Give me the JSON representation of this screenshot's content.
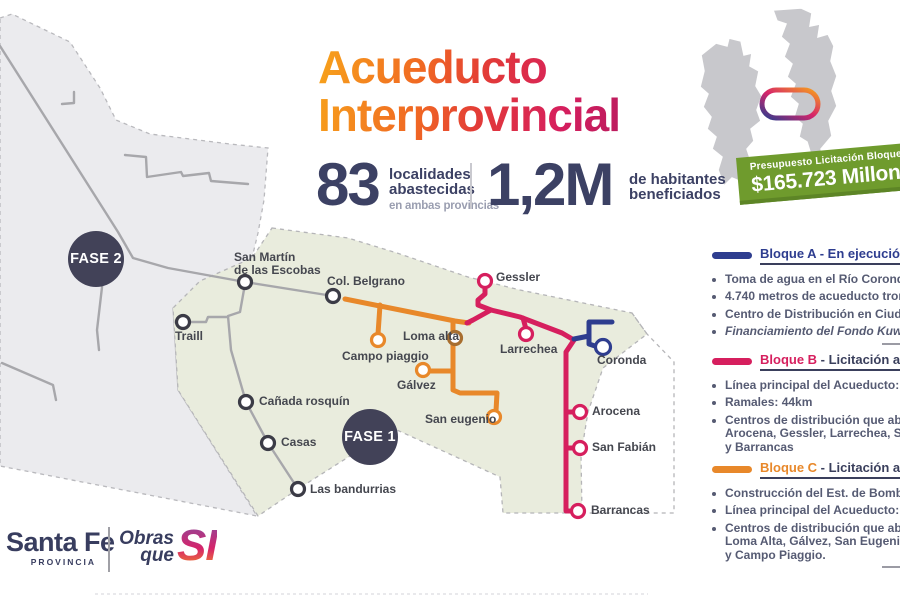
{
  "title": {
    "text": "Acueducto\nInterprovincial"
  },
  "stats": {
    "s1": {
      "value": "83",
      "line1": "localidades",
      "line2": "abastecidas",
      "sub": "en ambas provincias"
    },
    "s2": {
      "value": "1,2M",
      "line1": "de habitantes",
      "line2": "beneficiados"
    }
  },
  "banner": {
    "line1": "Presupuesto Licitación Bloques B y C",
    "line2": "$165.723 Millones",
    "bg_color": "#6f9b2d"
  },
  "fases": {
    "fase1": "FASE 1",
    "fase2": "FASE 2"
  },
  "towns": {
    "san_martin": "San Martín\nde las Escobas",
    "col_belgrano": "Col. Belgrano",
    "traill": "Traill",
    "canada_rosquin": "Cañada rosquín",
    "casas": "Casas",
    "las_bandurrias": "Las bandurrias",
    "campo_piaggio": "Campo piaggio",
    "loma_alta": "Loma alta",
    "galvez": "Gálvez",
    "san_eugenio": "San eugenio",
    "gessler": "Gessler",
    "larrechea": "Larrechea",
    "coronda": "Coronda",
    "arocena": "Arocena",
    "san_fabian": "San Fabián",
    "barrancas": "Barrancas"
  },
  "legend": {
    "blocks": [
      {
        "name": "Bloque A",
        "suffix": "- En ejecución",
        "color": "#2e3d8f",
        "suffix_color": "#2e3d8f",
        "divider_after": true,
        "items": [
          {
            "lines": [
              "Toma de agua en el Río Coronda"
            ]
          },
          {
            "lines": [
              "4.740 metros de acueducto troncal"
            ]
          },
          {
            "lines": [
              "Centro de Distribución en Ciudad de Coronda"
            ]
          },
          {
            "lines": [
              "Financiamiento del Fondo Kuwaití"
            ],
            "italic": true
          }
        ]
      },
      {
        "name": "Bloque B",
        "suffix": "- Licitación actual",
        "color": "#d61f5e",
        "suffix_color": "#3a3f5c",
        "divider_after": false,
        "items": [
          {
            "lines": [
              "Línea principal del Acueducto: 20,4km"
            ]
          },
          {
            "lines": [
              "Ramales: 44km"
            ]
          },
          {
            "lines": [
              "Centros de distribución que abastecerá:",
              "Arocena, Gessler, Larrechea, San Fabián",
              "y Barrancas"
            ]
          }
        ]
      },
      {
        "name": "Bloque C",
        "suffix": "- Licitación actual",
        "color": "#e8882a",
        "suffix_color": "#3a3f5c",
        "divider_after": true,
        "items": [
          {
            "lines": [
              "Construcción del Est. de Bombeo N°2"
            ]
          },
          {
            "lines": [
              "Línea principal del Acueducto: 17,7km"
            ]
          },
          {
            "lines": [
              "Centros de distribución que abastecerá:",
              "Loma Alta, Gálvez, San Eugenio, López",
              "y Campo Piaggio."
            ]
          }
        ]
      }
    ]
  },
  "logo": {
    "name": "Santa Fe",
    "sub": "PROVINCIA",
    "slogan": "Obras\nque",
    "slogan_si": "SI"
  },
  "colors": {
    "bloque_a": "#2e3d8f",
    "bloque_b": "#d61f5e",
    "bloque_c": "#e8882a",
    "navy_text": "#3c4164",
    "fase_badge": "#424258",
    "banner_green": "#6f9b2d",
    "zone_fase1_fill": "#e9ecdd",
    "zone_fase2_fill": "#ebebee",
    "network_gray": "#a7a7ab"
  }
}
